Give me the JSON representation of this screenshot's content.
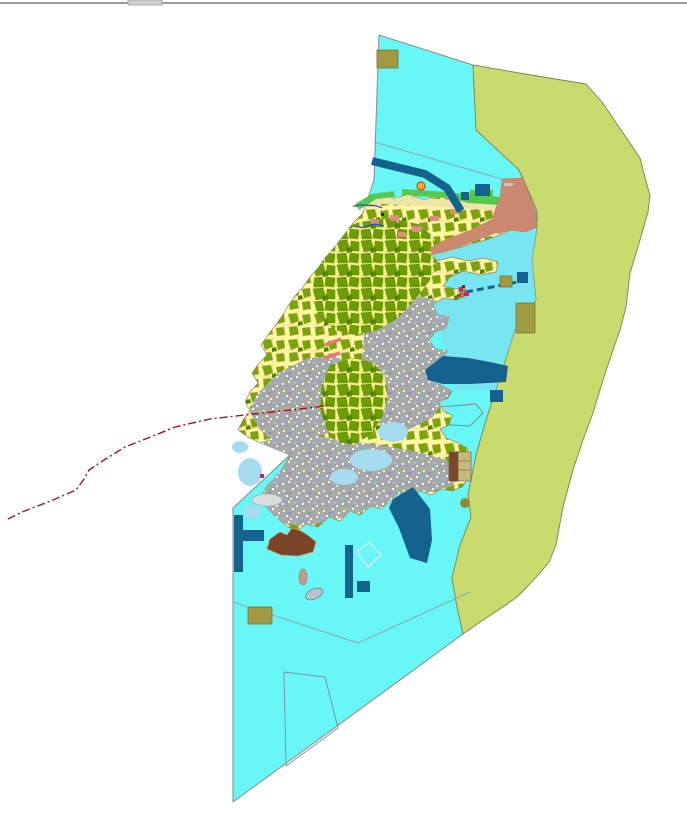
{
  "app": {
    "kind": "gis-map-viewport",
    "background": "#FFFFFF"
  },
  "window": {
    "splitter_color": "#9A9A9A",
    "splitter_tab_color": "#D0D0D0"
  },
  "map": {
    "width": 687,
    "height": 821,
    "palette": {
      "sea_cyan": "#69F6F6",
      "ne_bay_blue": "#8CD2EC",
      "coastal_buffer_olive": "#C9DA6F",
      "parcel_base_yellow": "#FEF9A0",
      "parcel_green": "#7AA40D",
      "urban_gray": "#A7A7B0",
      "reclamation_salmon": "#CC8870",
      "infrastructure_navy": "#15628F",
      "khaki_block": "#A09A42",
      "port_brown": "#7B4426",
      "boundary_red": "#A51212",
      "coast_strip_green": "#55C94F",
      "lagoon_blue": "#A6DCEF",
      "river_blue": "#2B52C9",
      "pink_road": "#E87878",
      "magenta_marker": "#C2257E"
    },
    "layers": [
      {
        "id": "sea-area",
        "kind": "polygon",
        "points": "379,35 473,65 476,130 519,170 525,183 537,211 537,228 532,260 536,300 515,330 508,352 496,390 486,420 476,455 468,495 471,517 460,545 452,578 456,602 463,634 233,802 233,508 293,452 285,430 277,400 274,370 282,340 302,305 322,273 342,243 357,225 363,213 374,180",
        "fill": "#69F6F6"
      },
      {
        "id": "coastal-buffer-zone",
        "kind": "polygon",
        "points": "473,65 525,74 586,84 602,102 640,158 650,196 648,212 640,240 630,273 626,307 620,330 613,350 603,380 593,413 583,440 573,470 563,507 556,545 549,562 540,573 527,587 517,597 503,607 483,620 463,634 456,602 452,578 460,545 471,517 468,495 476,455 486,420 496,390 508,352 515,330 536,300 532,260 537,228 537,211 525,183 519,170 476,130",
        "fill": "#C9DA6F",
        "stroke": "#7F7F50",
        "strokeWidth": 0.9
      },
      {
        "id": "ne-bay-tint",
        "kind": "polygon",
        "points": "410,245 537,230 533,262 536,300 516,330 508,352 496,390 455,390 440,330 425,280",
        "fill": "#8CD2EC",
        "opacity": 0.45
      },
      {
        "id": "sea-edge-west",
        "kind": "polyline",
        "points": "379,35 374,180 363,213",
        "stroke": "#8A8A8A",
        "strokeWidth": 1
      },
      {
        "id": "sea-edge-southwest",
        "kind": "polyline",
        "points": "293,452 233,508 233,802 463,634",
        "stroke": "#8A8A8A",
        "strokeWidth": 1
      },
      {
        "id": "sea-edge-north",
        "kind": "polyline",
        "points": "379,35 473,65",
        "stroke": "#8A8A8A",
        "strokeWidth": 1
      },
      {
        "id": "sea-parcel-line-north",
        "kind": "polyline",
        "points": "374,142 502,179",
        "stroke": "#8FA8B0",
        "strokeWidth": 1
      },
      {
        "id": "sea-parcel-line-south",
        "kind": "polyline",
        "points": "233,602 358,643 470,592",
        "stroke": "#8FA8B0",
        "strokeWidth": 1
      },
      {
        "id": "sea-parcel-quad",
        "kind": "polygon",
        "points": "284,672 325,677 338,728 286,766",
        "fill": "none",
        "stroke": "#7A96A8",
        "strokeWidth": 1
      },
      {
        "id": "sea-parcel-pentagon",
        "kind": "polygon",
        "points": "434,424 439,407 476,404 483,413 470,426",
        "fill": "none",
        "stroke": "#8A8A8A",
        "strokeWidth": 1
      },
      {
        "id": "sea-parcel-diamond",
        "kind": "polygon",
        "points": "357,552 369,542 381,555 368,567",
        "fill": "none",
        "stroke": "#E8E8E8",
        "strokeWidth": 1.2
      },
      {
        "id": "island-landuse",
        "kind": "path",
        "d": "M363,213 L368,198 L380,193 L394,199 L409,194 L424,200 L439,195 L455,201 L470,197 L486,203 L500,199 L512,205 L524,206 L536,213 L537,225 L528,231 L514,229 L500,235 L486,240 L470,244 L455,249 L441,247 L430,254 L437,261 L452,257 L468,261 L484,258 L498,262 L496,272 L481,275 L464,271 L450,277 L443,286 L455,289 L464,287 L468,295 L456,300 L443,298 L433,305 L438,315 L449,317 L446,328 L435,332 L429,341 L436,349 L447,351 L444,359 L433,362 L428,372 L432,381 L443,386 L452,391 L448,398 L439,402 L443,411 L452,415 L449,425 L440,429 L446,438 L458,443 L467,448 L471,457 L465,467 L469,477 L462,487 L452,491 L441,489 L431,495 L420,491 L409,497 L398,493 L389,502 L381,509 L371,506 L360,515 L350,511 L340,521 L329,517 L318,527 L306,524 L297,531 L288,527 L276,517 L266,507 L261,497 L266,487 L275,478 L283,468 L290,455 L278,450 L263,444 L248,437 L238,430 L243,420 L250,411 L245,402 L250,392 L258,383 L252,373 L259,363 L267,355 L261,345 L268,335 L275,326 L282,316 L288,306 L295,296 L303,287 L310,277 L318,268 L325,258 L333,249 L340,240 L347,231 L354,222 Z",
        "fill": "pattern:parcel",
        "stroke": "#8B8B6B",
        "strokeWidth": 0.7,
        "defineClip": "clip-island"
      },
      {
        "id": "urban-area-south",
        "kind": "polygon",
        "points": "250,446 280,436 315,436 350,441 385,446 418,452 446,460 458,472 452,486 430,492 406,497 384,506 358,514 332,520 306,526 286,524 270,514 261,500 263,486 272,472 262,462",
        "fill": "pattern:urban",
        "clip": true
      },
      {
        "id": "urban-area-west",
        "kind": "polygon",
        "points": "256,395 280,372 308,358 336,356 352,368 356,390 348,414 330,432 304,442 278,444 260,430 250,412",
        "fill": "pattern:urban",
        "clip": true
      },
      {
        "id": "urban-area-center",
        "kind": "polygon",
        "points": "372,298 402,293 432,299 456,311 468,338 463,372 450,393 432,418 406,431 382,427 368,407 362,369 364,333",
        "fill": "pattern:urban",
        "clip": true
      },
      {
        "id": "forest-cluster-north",
        "kind": "polygon",
        "points": "332,232 360,222 390,218 418,224 435,238 438,258 430,280 415,300 398,318 378,330 355,335 335,330 318,315 312,295 315,272 322,250",
        "fill": "pattern:parcelDense",
        "clip": true
      },
      {
        "id": "forest-cluster-center",
        "kind": "polygon",
        "points": "330,365 352,358 372,362 385,375 388,395 382,418 370,435 354,445 338,442 326,428 320,408 322,385",
        "fill": "pattern:parcelDense",
        "clip": true
      },
      {
        "id": "north-beach-strip",
        "kind": "polygon",
        "points": "356,206 380,196 420,198 460,200 500,203 500,211 460,208 420,206 380,204 360,212",
        "fill": "#EFE3A8",
        "clip": true
      },
      {
        "id": "coast-green-strip-west",
        "kind": "polygon",
        "points": "355,204 372,194 394,191 395,197 376,199 359,210",
        "fill": "#55C94F"
      },
      {
        "id": "coast-green-strip-mid",
        "kind": "polygon",
        "points": "402,189 447,192 446,198 402,195",
        "fill": "#55C94F"
      },
      {
        "id": "coast-green-strip-east",
        "kind": "polygon",
        "points": "455,193 500,197 500,205 468,203 455,199",
        "fill": "#55C94F"
      },
      {
        "id": "coast-green-block",
        "kind": "rect",
        "x": 470,
        "y": 190,
        "w": 23,
        "h": 12,
        "fill": "#55C94F"
      },
      {
        "id": "reclamation-zone-ne",
        "kind": "path",
        "d": "M502,179 L523,178 L536,212 L536,228 L524,232 L510,230 L498,234 L491,227 L494,213 L500,198 Z",
        "fill": "#CC8870",
        "stroke": "#B07A62",
        "strokeWidth": 0.5
      },
      {
        "id": "reclamation-band-coast",
        "kind": "polygon",
        "points": "430,248 444,240 470,230 496,217 505,223 496,233 470,243 446,252 432,255",
        "fill": "#CC8870"
      },
      {
        "id": "salmon-patch-1",
        "kind": "rect",
        "x": 390,
        "y": 215,
        "w": 9,
        "h": 6,
        "fill": "#D98E7E"
      },
      {
        "id": "salmon-patch-2",
        "kind": "rect",
        "x": 412,
        "y": 226,
        "w": 10,
        "h": 6,
        "fill": "#D98E7E"
      },
      {
        "id": "salmon-patch-3",
        "kind": "rect",
        "x": 430,
        "y": 216,
        "w": 9,
        "h": 5,
        "fill": "#D98E7E"
      },
      {
        "id": "salmon-patch-4",
        "kind": "rect",
        "x": 371,
        "y": 219,
        "w": 8,
        "h": 5,
        "fill": "#D98E7E"
      },
      {
        "id": "salmon-patch-5",
        "kind": "rect",
        "x": 450,
        "y": 209,
        "w": 8,
        "h": 5,
        "fill": "#D98E7E"
      },
      {
        "id": "salmon-patch-6",
        "kind": "rect",
        "x": 398,
        "y": 232,
        "w": 8,
        "h": 5,
        "fill": "#D98E7E"
      },
      {
        "id": "salmon-gray-dash",
        "kind": "rect",
        "x": 504,
        "y": 183,
        "w": 9,
        "h": 3,
        "fill": "#C4C4C4"
      },
      {
        "id": "lagoon-coast-nw",
        "kind": "ellipse",
        "cx": 240,
        "cy": 447,
        "rx": 8,
        "ry": 6,
        "fill": "#A6DCEF"
      },
      {
        "id": "lagoon-coast-w1",
        "kind": "ellipse",
        "cx": 250,
        "cy": 472,
        "rx": 12,
        "ry": 14,
        "fill": "#A6DCEF"
      },
      {
        "id": "lagoon-coast-w2",
        "kind": "ellipse",
        "cx": 252,
        "cy": 512,
        "rx": 9,
        "ry": 7,
        "fill": "#A6DCEF"
      },
      {
        "id": "lagoon-mid-1",
        "kind": "ellipse",
        "cx": 371,
        "cy": 460,
        "rx": 21,
        "ry": 11,
        "fill": "#A6DCEF",
        "clip": true
      },
      {
        "id": "lagoon-mid-2",
        "kind": "ellipse",
        "cx": 393,
        "cy": 432,
        "rx": 15,
        "ry": 10,
        "fill": "#A6DCEF",
        "clip": true
      },
      {
        "id": "lagoon-east",
        "kind": "ellipse",
        "cx": 457,
        "cy": 346,
        "rx": 11,
        "ry": 9,
        "fill": "#A6DCEF",
        "clip": true
      },
      {
        "id": "lagoon-south",
        "kind": "ellipse",
        "cx": 344,
        "cy": 477,
        "rx": 14,
        "ry": 8,
        "fill": "#A6DCEF",
        "clip": true
      },
      {
        "id": "navy-channel-ne",
        "kind": "polyline",
        "points": "372,161 425,174 447,188 461,211",
        "stroke": "#15628F",
        "strokeWidth": 8,
        "linecap": "butt",
        "fill": "none"
      },
      {
        "id": "navy-block-ne-1",
        "kind": "rect",
        "x": 475,
        "y": 184,
        "w": 15,
        "h": 12,
        "fill": "#15628F"
      },
      {
        "id": "navy-block-ne-2",
        "kind": "rect",
        "x": 461,
        "y": 192,
        "w": 8,
        "h": 8,
        "fill": "#15628F"
      },
      {
        "id": "navy-block-east",
        "kind": "rect",
        "x": 517,
        "y": 272,
        "w": 11,
        "h": 11,
        "fill": "#15628F"
      },
      {
        "id": "navy-dashed-pipeline",
        "kind": "polyline",
        "points": "466,292 523,281",
        "stroke": "#15628F",
        "strokeWidth": 3,
        "dash": "7 4",
        "fill": "none"
      },
      {
        "id": "navy-basin-center-east",
        "kind": "polygon",
        "points": "425,370 443,356 468,358 490,362 508,366 506,382 470,384 443,384 428,380",
        "fill": "#15628F"
      },
      {
        "id": "navy-block-center",
        "kind": "rect",
        "x": 490,
        "y": 390,
        "w": 13,
        "h": 12,
        "fill": "#15628F"
      },
      {
        "id": "navy-band-south",
        "kind": "polygon",
        "points": "393,499 413,487 430,509 432,540 427,563 410,558 399,528 389,508",
        "fill": "#15628F"
      },
      {
        "id": "navy-bar-south",
        "kind": "rect",
        "x": 345,
        "y": 545,
        "w": 8,
        "h": 53,
        "fill": "#15628F"
      },
      {
        "id": "navy-square-south",
        "kind": "rect",
        "x": 357,
        "y": 581,
        "w": 13,
        "h": 11,
        "fill": "#15628F"
      },
      {
        "id": "navy-tee-vertical",
        "kind": "rect",
        "x": 234,
        "y": 515,
        "w": 9,
        "h": 57,
        "fill": "#15628F"
      },
      {
        "id": "navy-tee-horizontal",
        "kind": "rect",
        "x": 234,
        "y": 530,
        "w": 30,
        "h": 11,
        "fill": "#15628F"
      },
      {
        "id": "khaki-block-north",
        "kind": "rect",
        "x": 377,
        "y": 50,
        "w": 21,
        "h": 18,
        "fill": "#A09A42",
        "stroke": "#77732E",
        "strokeWidth": 0.8
      },
      {
        "id": "khaki-block-east-small",
        "kind": "rect",
        "x": 500,
        "y": 276,
        "w": 12,
        "h": 11,
        "fill": "#A09A42",
        "stroke": "#77732E",
        "strokeWidth": 0.7
      },
      {
        "id": "khaki-block-east-large",
        "kind": "rect",
        "x": 516,
        "y": 303,
        "w": 19,
        "h": 30,
        "fill": "#A09A42",
        "stroke": "#77732E",
        "strokeWidth": 0.7
      },
      {
        "id": "khaki-block-south",
        "kind": "rect",
        "x": 248,
        "y": 607,
        "w": 24,
        "h": 17,
        "fill": "#A09A42",
        "stroke": "#77732E",
        "strokeWidth": 0.7
      },
      {
        "id": "khaki-dot-se",
        "kind": "circle",
        "cx": 465,
        "cy": 503,
        "r": 5,
        "fill": "#8F8A33"
      },
      {
        "id": "legend-box-left",
        "kind": "rect",
        "x": 449,
        "y": 452,
        "w": 9,
        "h": 29,
        "fill": "#7B4A28",
        "stroke": "#555555",
        "strokeWidth": 0.6
      },
      {
        "id": "legend-box-right",
        "kind": "rect",
        "x": 458,
        "y": 452,
        "w": 13,
        "h": 29,
        "fill": "#C9B97B",
        "stroke": "#555555",
        "strokeWidth": 0.6
      },
      {
        "id": "legend-box-line-1",
        "kind": "polyline",
        "points": "458,461 471,461",
        "stroke": "#8A7A4A",
        "strokeWidth": 0.8
      },
      {
        "id": "legend-box-line-2",
        "kind": "polyline",
        "points": "458,470 471,470",
        "stroke": "#8A7A4A",
        "strokeWidth": 0.8
      },
      {
        "id": "port-brown-blob",
        "kind": "polygon",
        "points": "267,549 270,539 280,532 287,535 292,528 301,531 309,536 316,542 313,552 298,556 281,555",
        "fill": "#7B4426",
        "stroke": "#D98A50",
        "strokeWidth": 0.7
      },
      {
        "id": "islet-tan",
        "kind": "ellipse",
        "cx": 303,
        "cy": 577,
        "rx": 4,
        "ry": 8,
        "fill": "#C49A82",
        "stroke": "#8A8A8A",
        "strokeWidth": 0.7
      },
      {
        "id": "islet-gray",
        "kind": "ellipse",
        "cx": 314,
        "cy": 594,
        "rx": 9,
        "ry": 5,
        "fill": "#B8C4CC",
        "stroke": "#667788",
        "strokeWidth": 0.7,
        "transform": "rotate(-25 314 594)"
      },
      {
        "id": "coastal-flat-gray",
        "kind": "ellipse",
        "cx": 267,
        "cy": 500,
        "rx": 15,
        "ry": 6,
        "fill": "#DCDCDC",
        "stroke": "#B0B0B0",
        "strokeWidth": 0.7
      },
      {
        "id": "river-north-1",
        "kind": "path",
        "d": "M382,208 C374,204 368,206 363,205 C358,204 356,207 353,206",
        "fill": "none",
        "stroke": "#2B52C9",
        "strokeWidth": 1.3
      },
      {
        "id": "river-north-2",
        "kind": "path",
        "d": "M384,226 C375,222 370,226 365,227 C361,228 358,226 356,227",
        "fill": "none",
        "stroke": "#2B52C9",
        "strokeWidth": 1.3
      },
      {
        "id": "river-mouth-dot",
        "kind": "rect",
        "x": 381,
        "y": 213,
        "w": 3,
        "h": 3,
        "fill": "#222A7A"
      },
      {
        "id": "pink-road-1",
        "kind": "polyline",
        "points": "325,345 341,339",
        "stroke": "#E87878",
        "strokeWidth": 3.5
      },
      {
        "id": "pink-road-2",
        "kind": "polyline",
        "points": "324,358 340,353",
        "stroke": "#E87878",
        "strokeWidth": 3.5
      },
      {
        "id": "magenta-marker-1",
        "kind": "rect",
        "x": 459,
        "y": 287,
        "w": 4,
        "h": 4,
        "fill": "#C2257E"
      },
      {
        "id": "magenta-marker-2",
        "kind": "rect",
        "x": 464,
        "y": 292,
        "w": 5,
        "h": 4,
        "fill": "#C2257E"
      },
      {
        "id": "magenta-marker-3",
        "kind": "rect",
        "x": 457,
        "y": 294,
        "w": 4,
        "h": 3,
        "fill": "#C2257E"
      },
      {
        "id": "darkred-marker",
        "kind": "rect",
        "x": 462,
        "y": 285,
        "w": 3,
        "h": 3,
        "fill": "#8A1A2A"
      },
      {
        "id": "magenta-marker-west",
        "kind": "rect",
        "x": 260,
        "y": 474,
        "w": 4,
        "h": 4,
        "fill": "#C2257E"
      },
      {
        "id": "boundary-red-dashline",
        "kind": "polyline",
        "points": "8,519 22,512 53,500 76,490 84,479 89,470 104,460 125,447 148,438 175,427 210,419 253,414 300,409 331,405",
        "stroke": "#A51212",
        "strokeWidth": 1.4,
        "dash": "8 3 2 3",
        "fill": "none"
      },
      {
        "id": "orange-point-marker",
        "kind": "circle",
        "cx": 421,
        "cy": 186,
        "r": 4,
        "fill": "#F5B32A",
        "stroke": "#CC4422",
        "strokeWidth": 1.2
      },
      {
        "id": "top-splitter-line",
        "kind": "rect",
        "x": 0,
        "y": 2,
        "w": 687,
        "h": 2,
        "fill": "#9A9A9A"
      },
      {
        "id": "top-splitter-tab",
        "kind": "rect",
        "x": 128,
        "y": 0,
        "w": 34,
        "h": 5,
        "fill": "#D0D0D0",
        "stroke": "#9A9A9A",
        "strokeWidth": 0.8,
        "interactable": true
      }
    ]
  }
}
